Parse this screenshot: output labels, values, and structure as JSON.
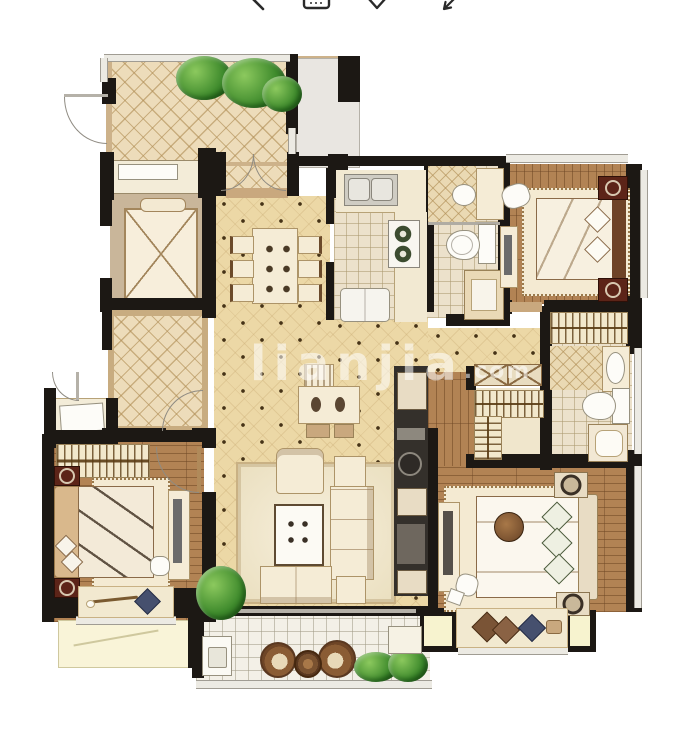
{
  "toolbar": {
    "icons": [
      {
        "name": "back-icon"
      },
      {
        "name": "keyboard-icon"
      },
      {
        "name": "heart-icon"
      },
      {
        "name": "share-arrow-icon"
      }
    ]
  },
  "watermark": {
    "brand": "lianjia",
    "tld": ".com"
  },
  "colors": {
    "wall": "#1c1814",
    "hall_floor": "#ecd8a6",
    "terrace_floor": "#eddcba",
    "wood_floor": "#b28354",
    "tile_floor": "#ece1cb",
    "balcony_tile": "#f3f0e7",
    "furniture_cream": "#f5ecd6",
    "nightstand_red": "#5c2418",
    "plant_green": "#3e8a2c",
    "watermark_white": "rgba(255,255,255,0.55)"
  },
  "floorplan": {
    "type": "residential-floor-plan",
    "rooms": [
      {
        "name": "terrace",
        "features": [
          "lattice-tile-floor",
          "corner-plants",
          "french-doors"
        ]
      },
      {
        "name": "elevator",
        "features": [
          "elevator-cab-x-symbol"
        ]
      },
      {
        "name": "stair-lobby",
        "features": [
          "lattice-tile-floor",
          "door"
        ]
      },
      {
        "name": "entry-porch",
        "features": [
          "door"
        ]
      },
      {
        "name": "living-dining-hall",
        "features": [
          "dining-table-6-chairs",
          "tea-table",
          "sofa-set",
          "coffee-table",
          "media-wall",
          "plant"
        ]
      },
      {
        "name": "kitchen",
        "features": [
          "double-sink",
          "stove-2-burners",
          "fridge"
        ]
      },
      {
        "name": "bathroom-1",
        "features": [
          "shower",
          "washbasin",
          "toilet",
          "cabinet"
        ]
      },
      {
        "name": "bedroom-1",
        "features": [
          "double-bed",
          "2-nightstands",
          "desk",
          "rug",
          "closet"
        ]
      },
      {
        "name": "bathroom-2",
        "features": [
          "shower",
          "washbasin",
          "toilet",
          "bathtub"
        ]
      },
      {
        "name": "walk-in-closet",
        "features": [
          "hanger-racks",
          "x-cabinet"
        ]
      },
      {
        "name": "bedroom-2",
        "features": [
          "double-bed",
          "2-nightstands",
          "desk",
          "rug",
          "bay-window-seat"
        ]
      },
      {
        "name": "bedroom-3",
        "features": [
          "double-bed",
          "2-nightstands",
          "desk",
          "rug",
          "closet",
          "bay-window-seat"
        ]
      },
      {
        "name": "balcony",
        "features": [
          "white-tile-floor",
          "washer",
          "2-round-chairs",
          "round-table",
          "plants",
          "cabinet"
        ]
      },
      {
        "name": "ac-platform",
        "features": []
      }
    ]
  }
}
